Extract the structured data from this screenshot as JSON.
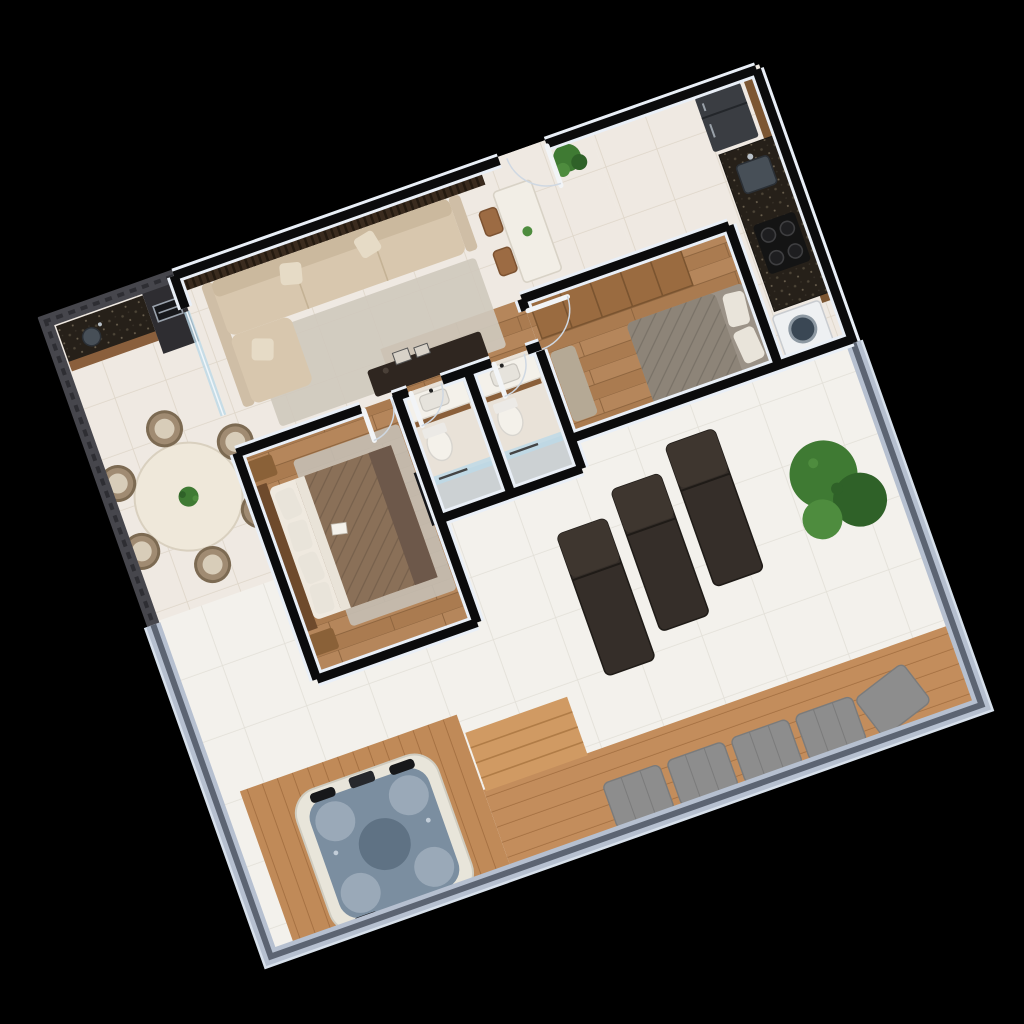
{
  "scene": {
    "kind": "3d-floor-plan-render",
    "description": "Isometric 3D render of a two-bedroom apartment floor plan with wraparound terrace, rotated on a black background",
    "rotation_deg": -19.5,
    "background": "#000000"
  },
  "palette": {
    "background": "#000000",
    "wall_cap": "#0b0b0c",
    "wall_edge": "#e9eff7",
    "dark_feature_wall": "#46464c",
    "dark_wall_accent": "#2e2e33",
    "parapet_face": "#b6c0d0",
    "parapet_top": "#5c6472",
    "parapet_outer": "#d7e0eb",
    "interior_tile": "#efe9e2",
    "terrace_tile": "#f3f1ec",
    "bath_floor": "#e9e2d8",
    "sofa": "#d8c7ae",
    "sofa_back": "#cbb99e",
    "sofa_arm": "#cfbea6",
    "pillow_beige": "#e6dbc6",
    "rug_living": "#cfc9bd",
    "tv_console": "#2f2620",
    "frame_art": "#d8d2c8",
    "round_table": "#efe8da",
    "chair_rattan": "#a08b72",
    "chair_seat": "#d8cdb9",
    "grill_tower": "#2e2d31",
    "grill_box": "#17181b",
    "grill_steel": "#9aa2ac",
    "counter_wood_front": "#8a5f3c",
    "marble_table": "#f2eee6",
    "wood_chair": "#9c6b43",
    "fridge": "#3a3d42",
    "sink_steel": "#474f57",
    "cooktop": "#141414",
    "washer": "#eef0f2",
    "washer_door": "#3a4754",
    "tank": "#eceff1",
    "wardrobe": "#9a6b40",
    "bed2_cover": "#8d8478",
    "pillow_white": "#e9e4da",
    "bench": "#b5a995",
    "vanity_wood": "#8a5f3a",
    "fixture_white": "#f4f1ea",
    "shower_floor": "#ccd1d3",
    "glass": "#bcd9e8",
    "headboard": "#6e4a2c",
    "nightstand": "#8a6138",
    "bed1_quilt": "#8a7058",
    "bed1_throw": "#6d584a",
    "rug_bedroom": "#c6c0b6",
    "wall_tv": "#15161a",
    "lounger": "#352e29",
    "lounger_back": "#3e362f",
    "cushion_gray": "#8d8d8d",
    "tub_shell": "#e8e5da",
    "tub_water": "#7b8ea0",
    "tub_seat": "#9aa9b8",
    "tub_center": "#5f7284",
    "tub_pad": "#17181a",
    "plant_green": "#3f7a33",
    "plant_dark": "#2f6128",
    "plant_light": "#4e8c3e",
    "pot": "#c9c2b4",
    "deck_wood": "#c08a58",
    "step_wood": "#d09a63",
    "door_leaf": "#f2f4f6"
  },
  "rooms": [
    {
      "id": "gourmet-terrace",
      "label": "Gourmet / dining terrace",
      "furniture": [
        "barbecue counter with granite top and sink",
        "grill tower",
        "round dining table",
        "rattan chair x6",
        "plant centerpiece"
      ]
    },
    {
      "id": "living-room",
      "label": "Living room",
      "furniture": [
        "wood slat feature wall",
        "L-shaped beige sofa",
        "throw pillows",
        "area rug",
        "TV console with picture frames",
        "glass partition"
      ]
    },
    {
      "id": "entry",
      "label": "Entry",
      "furniture": [
        "entry door",
        "marble bistro table",
        "wood chair x2",
        "potted plant"
      ]
    },
    {
      "id": "kitchen",
      "label": "Kitchen",
      "furniture": [
        "refrigerator",
        "granite countertop",
        "sink with faucet",
        "4-burner cooktop",
        "wood cabinetry"
      ]
    },
    {
      "id": "laundry",
      "label": "Laundry nook",
      "furniture": [
        "washing machine",
        "laundry tank"
      ]
    },
    {
      "id": "bedroom-2",
      "label": "Bedroom 2",
      "furniture": [
        "wardrobe",
        "double bed with gray cover",
        "bench",
        "wood plank floor"
      ]
    },
    {
      "id": "bathroom-1",
      "label": "Bathroom 1",
      "furniture": [
        "vanity with wood base",
        "toilet",
        "glass shower"
      ]
    },
    {
      "id": "bathroom-2",
      "label": "Bathroom 2",
      "furniture": [
        "vanity with wood base",
        "toilet",
        "glass shower"
      ]
    },
    {
      "id": "master-bedroom",
      "label": "Master bedroom",
      "furniture": [
        "wood headboard panel",
        "double bed with brown quilt",
        "nightstand x2",
        "gray area rug",
        "wall TV"
      ]
    },
    {
      "id": "terrace",
      "label": "Wraparound terrace",
      "furniture": [
        "sun lounger x3",
        "corner plants",
        "wood deck",
        "deck steps",
        "tufted cushion bench",
        "hot tub"
      ]
    }
  ],
  "counts": {
    "bedrooms": 2,
    "bathrooms": 2,
    "dining_chairs": 6,
    "bistro_chairs": 2,
    "sun_loungers": 3,
    "bench_cushions": 5,
    "cooktop_burners": 4,
    "hot_tub_headrests": 3
  }
}
